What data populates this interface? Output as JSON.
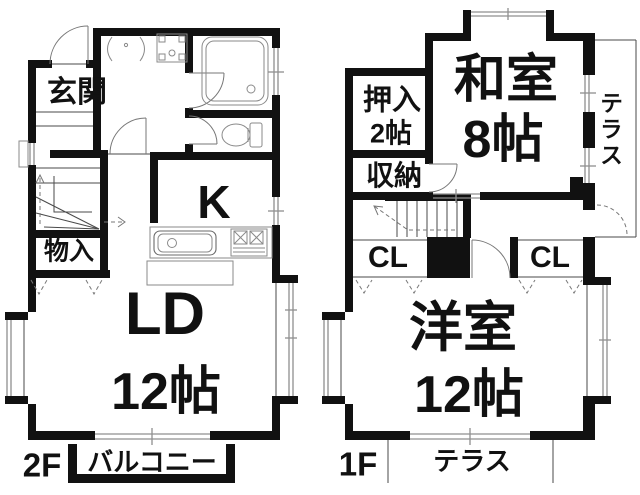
{
  "colors": {
    "background": "#ffffff",
    "wall": "#111111",
    "thin_line": "#4a4a4a",
    "window_line": "#8f8f8f",
    "text": "#111111"
  },
  "floor2": {
    "floor_label": "2F",
    "genkan": "玄関",
    "monoire": "物入",
    "kitchen": "K",
    "ld_name": "LD",
    "ld_size": "12帖",
    "balcony": "バルコニー"
  },
  "floor1": {
    "floor_label": "1F",
    "washitsu_name": "和室",
    "washitsu_size": "8帖",
    "oshiire_name": "押入",
    "oshiire_size": "2帖",
    "shuno": "収納",
    "cl_left": "CL",
    "cl_right": "CL",
    "yoshitsu_name": "洋室",
    "yoshitsu_size": "12帖",
    "terrace_side": "テラス",
    "terrace_bottom": "テラス"
  },
  "fixtures": {
    "bathtub": "bathtub",
    "toilet": "toilet",
    "washbasin": "washbasin",
    "washer_pan": "washing-machine-pan",
    "kitchen_sink": "kitchen-sink",
    "stove": "gas-stove",
    "stairs_2f": "winder-stairs",
    "stairs_1f": "straight-stairs"
  }
}
